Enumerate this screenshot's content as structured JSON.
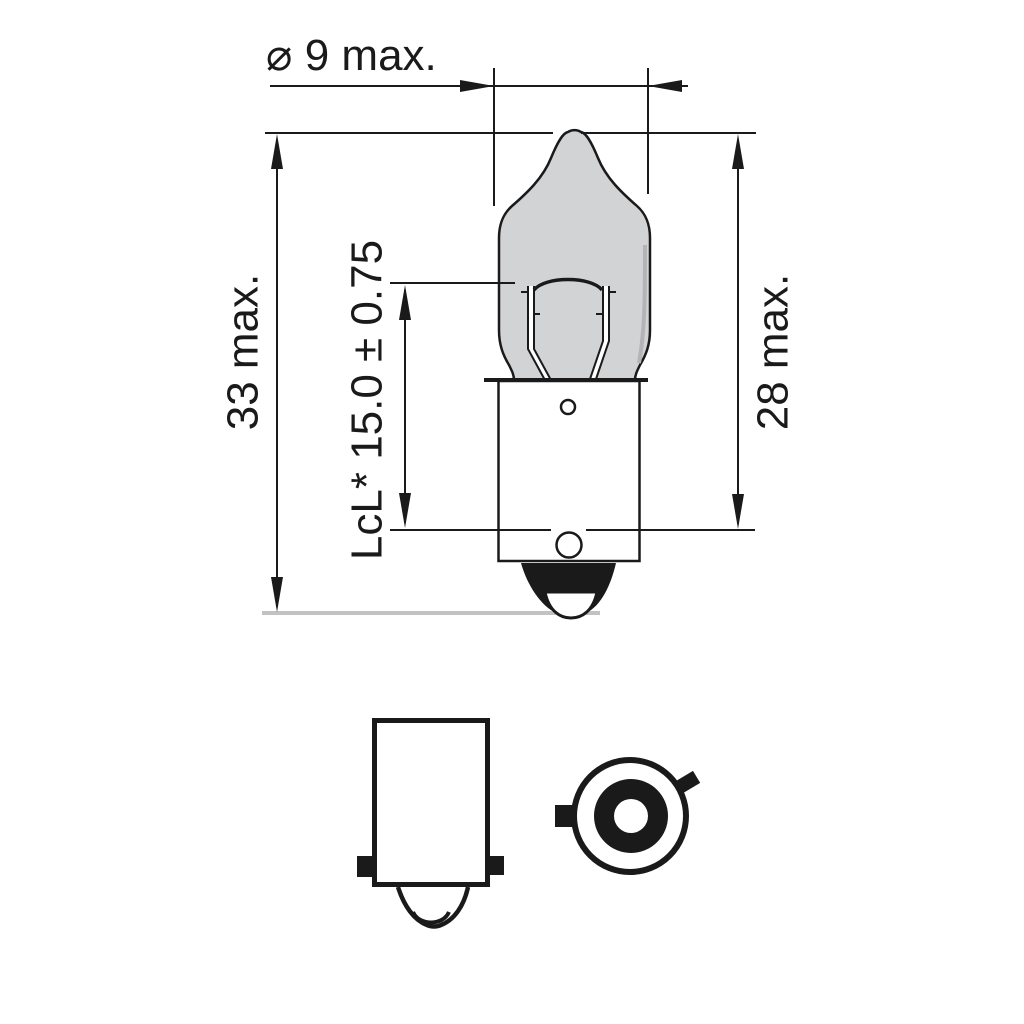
{
  "drawing": {
    "labels": {
      "diameter": "⌀ 9 max.",
      "overall_length": "33 max.",
      "lcl": "LcL* 15.0 ± 0.75",
      "envelope_length": "28 max."
    },
    "colors": {
      "ink": "#1a1a1a",
      "glass": "#d2d3d5",
      "glass_shade": "#b4b4b8",
      "baseline": "#c2c2c4",
      "background": "#ffffff"
    }
  }
}
